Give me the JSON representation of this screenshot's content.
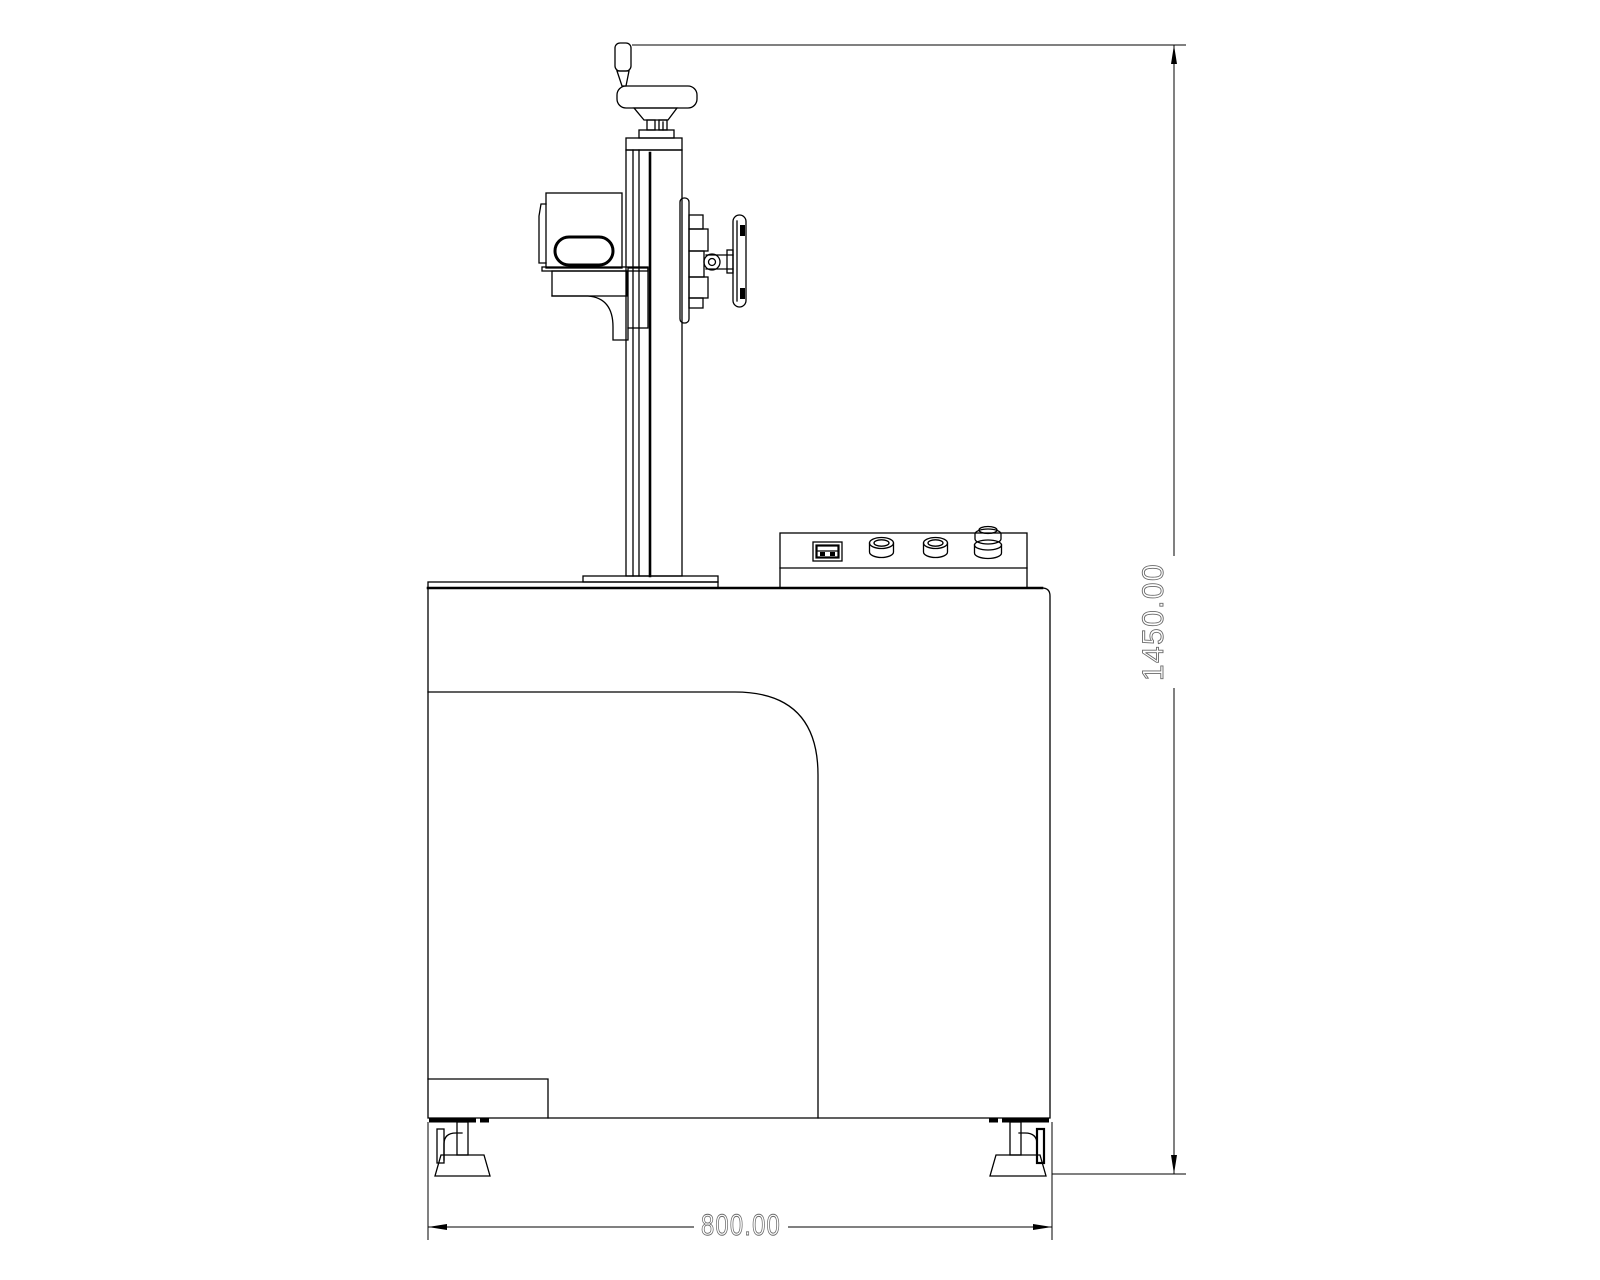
{
  "drawing": {
    "kind": "cad-elevation-view",
    "background_color": "#ffffff",
    "line_color": "#000000",
    "dimension_text_color": "#6a6a6a"
  },
  "dimensions": {
    "height_label": "1450.00",
    "width_label": "800.00"
  }
}
